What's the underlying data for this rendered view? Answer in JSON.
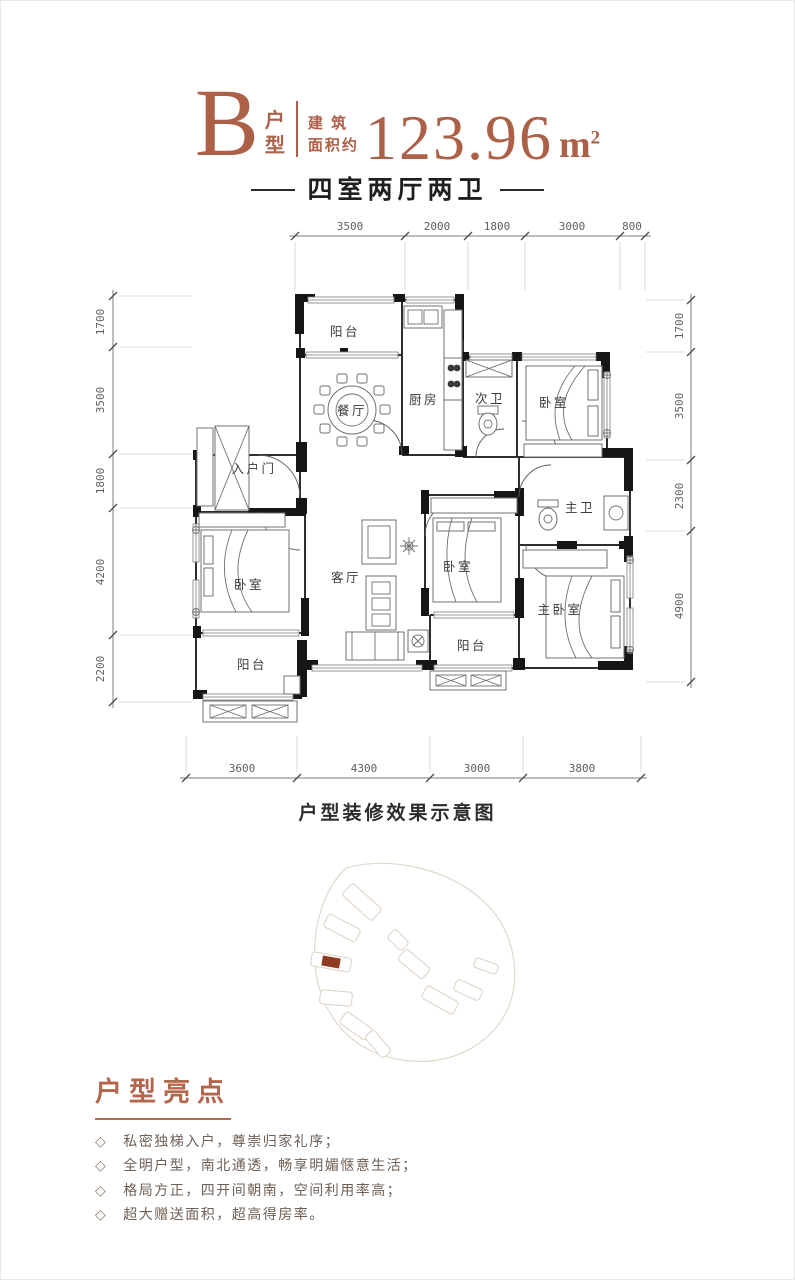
{
  "header": {
    "type_letter": "B",
    "type_label_top": "户",
    "type_label_bottom": "型",
    "area_prefix_line1": "建 筑",
    "area_prefix_line2": "面积约",
    "area_value": "123.96",
    "area_unit_base": "m",
    "area_unit_exponent": "2",
    "subtitle": "四室两厅两卫",
    "accent_color": "#ac6047"
  },
  "floorplan": {
    "caption": "户型装修效果示意图",
    "rooms": {
      "balcony_north": "阳台",
      "dining": "餐厅",
      "kitchen": "厨房",
      "bath_second": "次卫",
      "bedroom_ne": "卧室",
      "entrance": "入户门",
      "bedroom_west": "卧室",
      "living": "客厅",
      "bedroom_mid": "卧室",
      "bath_master": "主卫",
      "bedroom_master": "主卧室",
      "balcony_southwest": "阳台",
      "balcony_south": "阳台"
    },
    "dimensions": {
      "top": [
        "3500",
        "2000",
        "1800",
        "3000",
        "800"
      ],
      "bottom": [
        "3600",
        "4300",
        "3000",
        "3800"
      ],
      "left": [
        "1700",
        "3500",
        "1800",
        "4200",
        "2200"
      ],
      "right": [
        "1700",
        "3500",
        "2300",
        "4900"
      ]
    }
  },
  "site_plan": {
    "highlight_color": "#8e3b22"
  },
  "highlights": {
    "title": "户型亮点",
    "bullet": "◇",
    "items": [
      "私密独梯入户，尊崇归家礼序；",
      "全明户型，南北通透，畅享明媚惬意生活；",
      "格局方正，四开间朝南，空间利用率高；",
      "超大赠送面积，超高得房率。"
    ]
  }
}
